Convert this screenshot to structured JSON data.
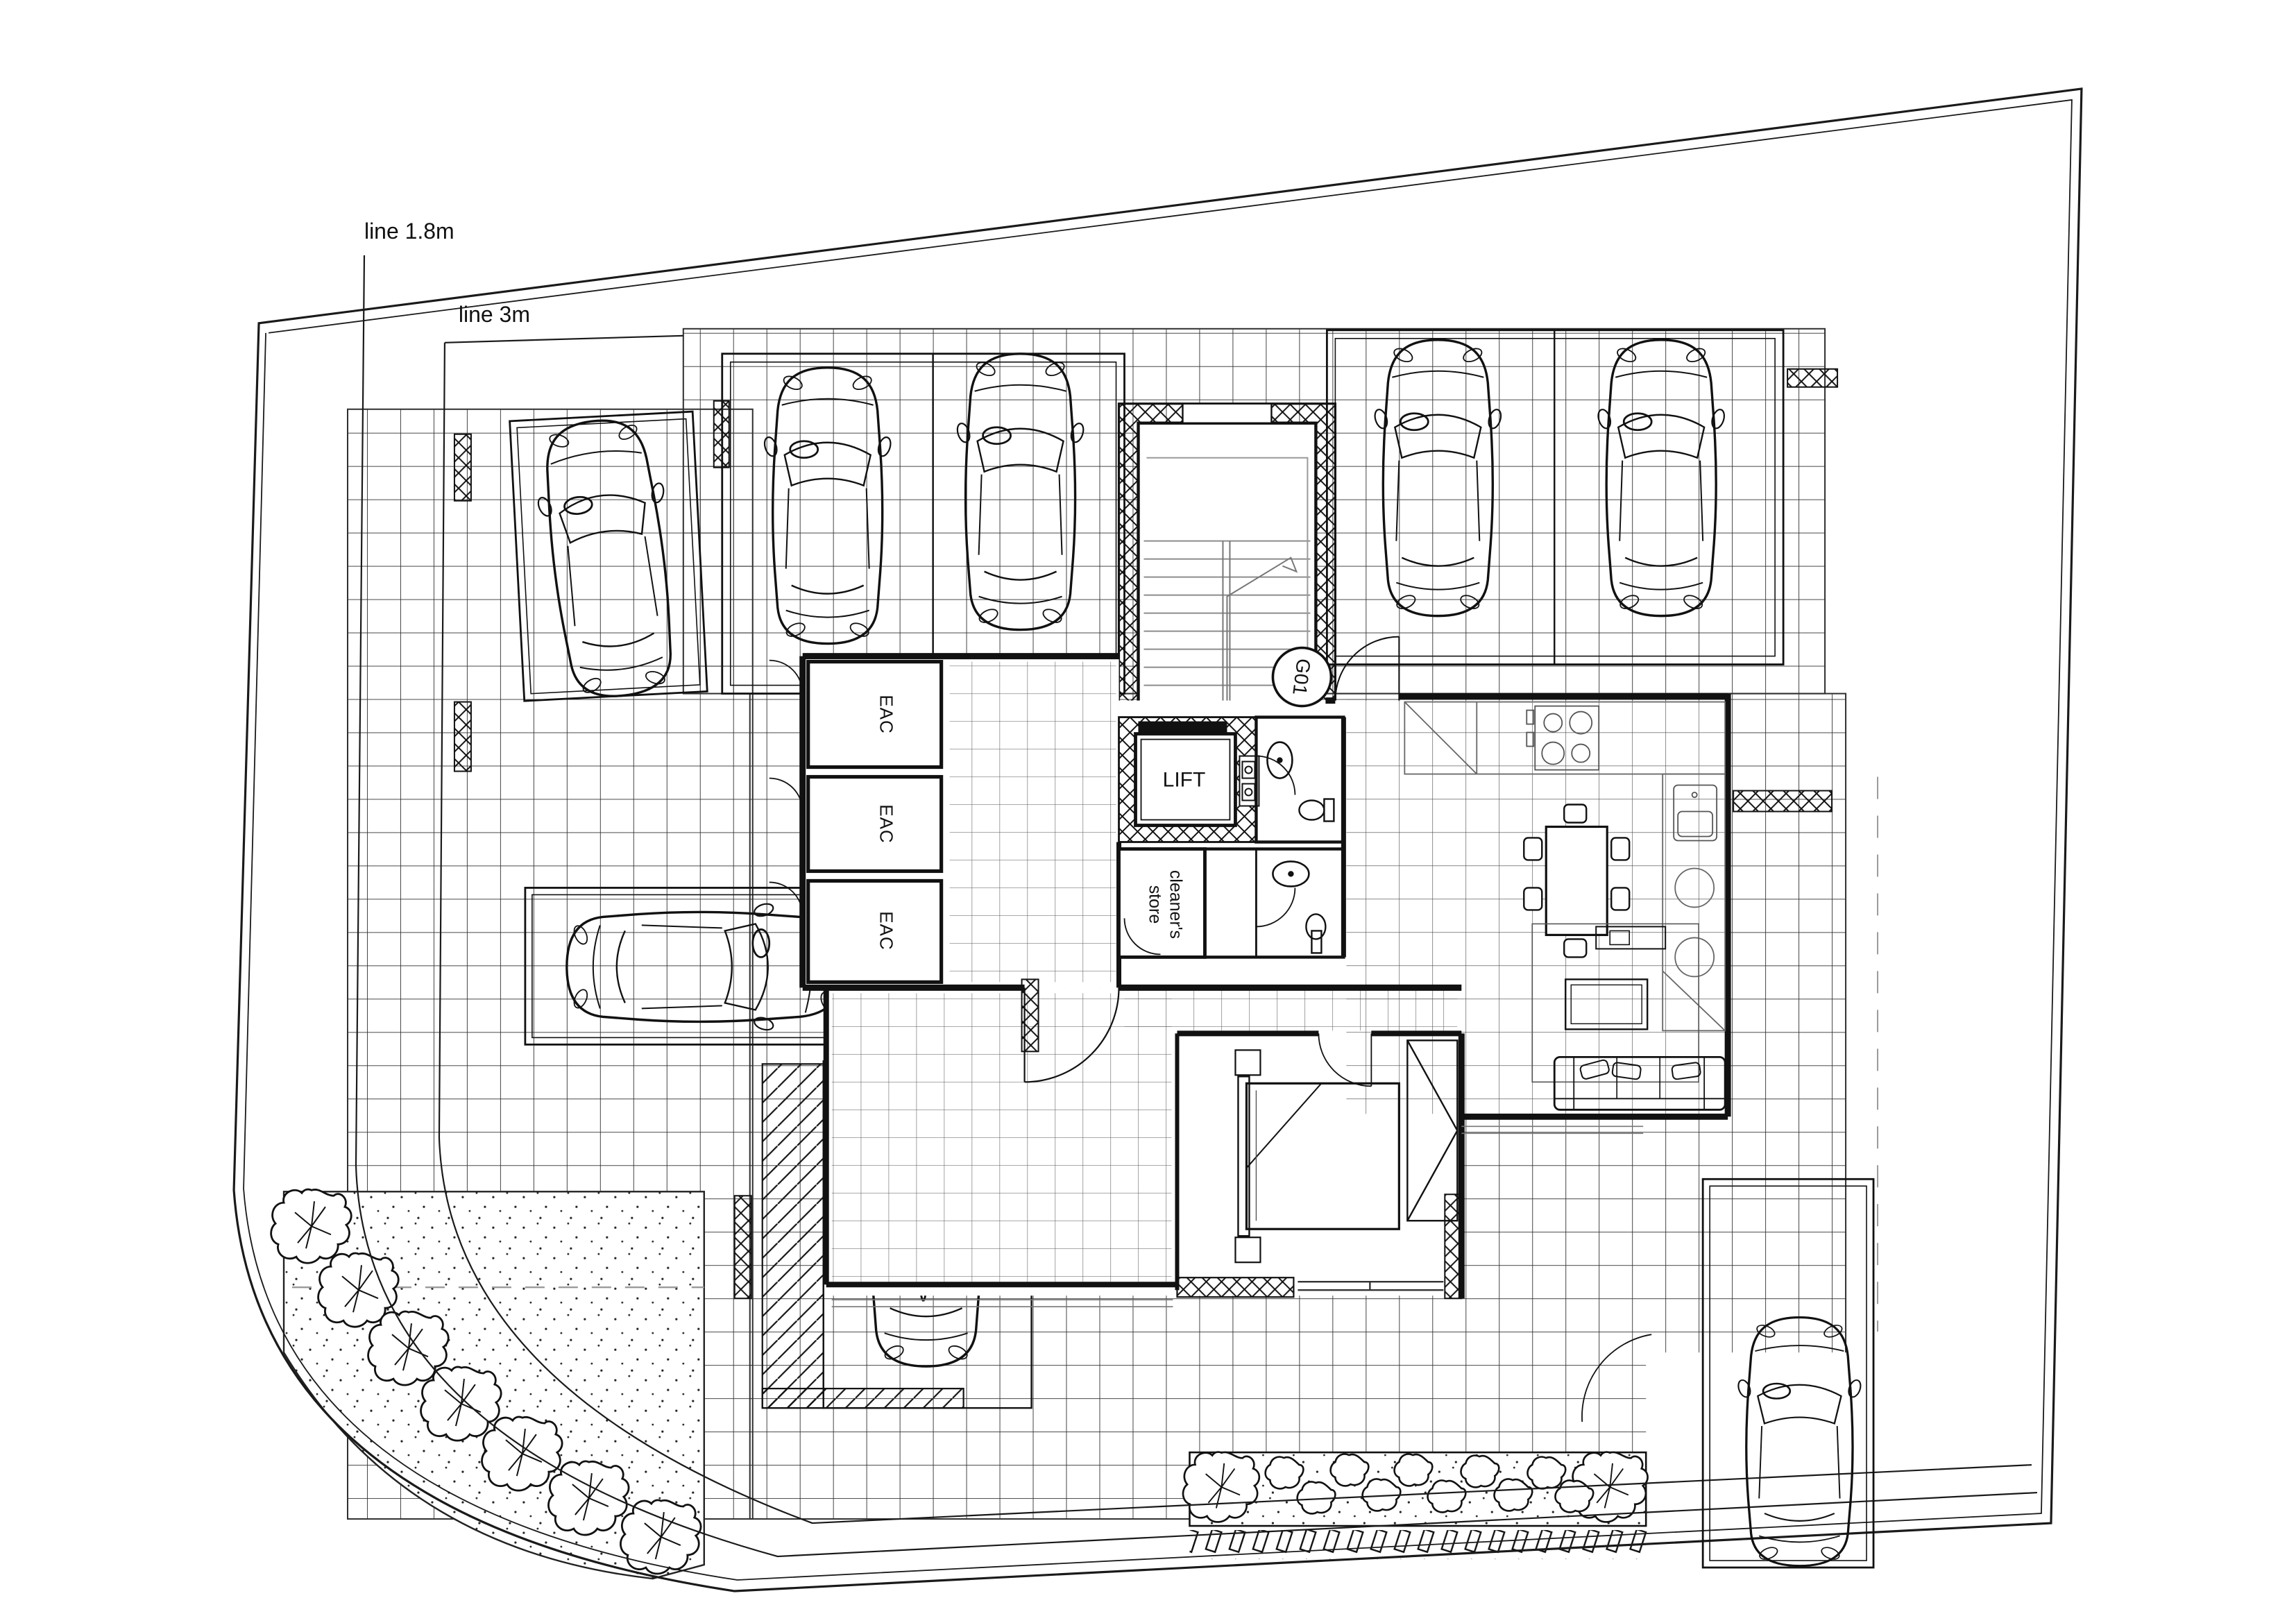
{
  "labels": {
    "setback_1_8": "line 1.8m",
    "setback_3": "line 3m",
    "lift": "LIFT",
    "unit": "G01",
    "cleaners_line1": "cleaner's",
    "cleaners_line2": "store",
    "eac": [
      "EAC",
      "EAC",
      "EAC"
    ]
  },
  "colors": {
    "line": "#1a1a1a",
    "grid": "#2f2f2f",
    "light": "#8a8a8a"
  }
}
